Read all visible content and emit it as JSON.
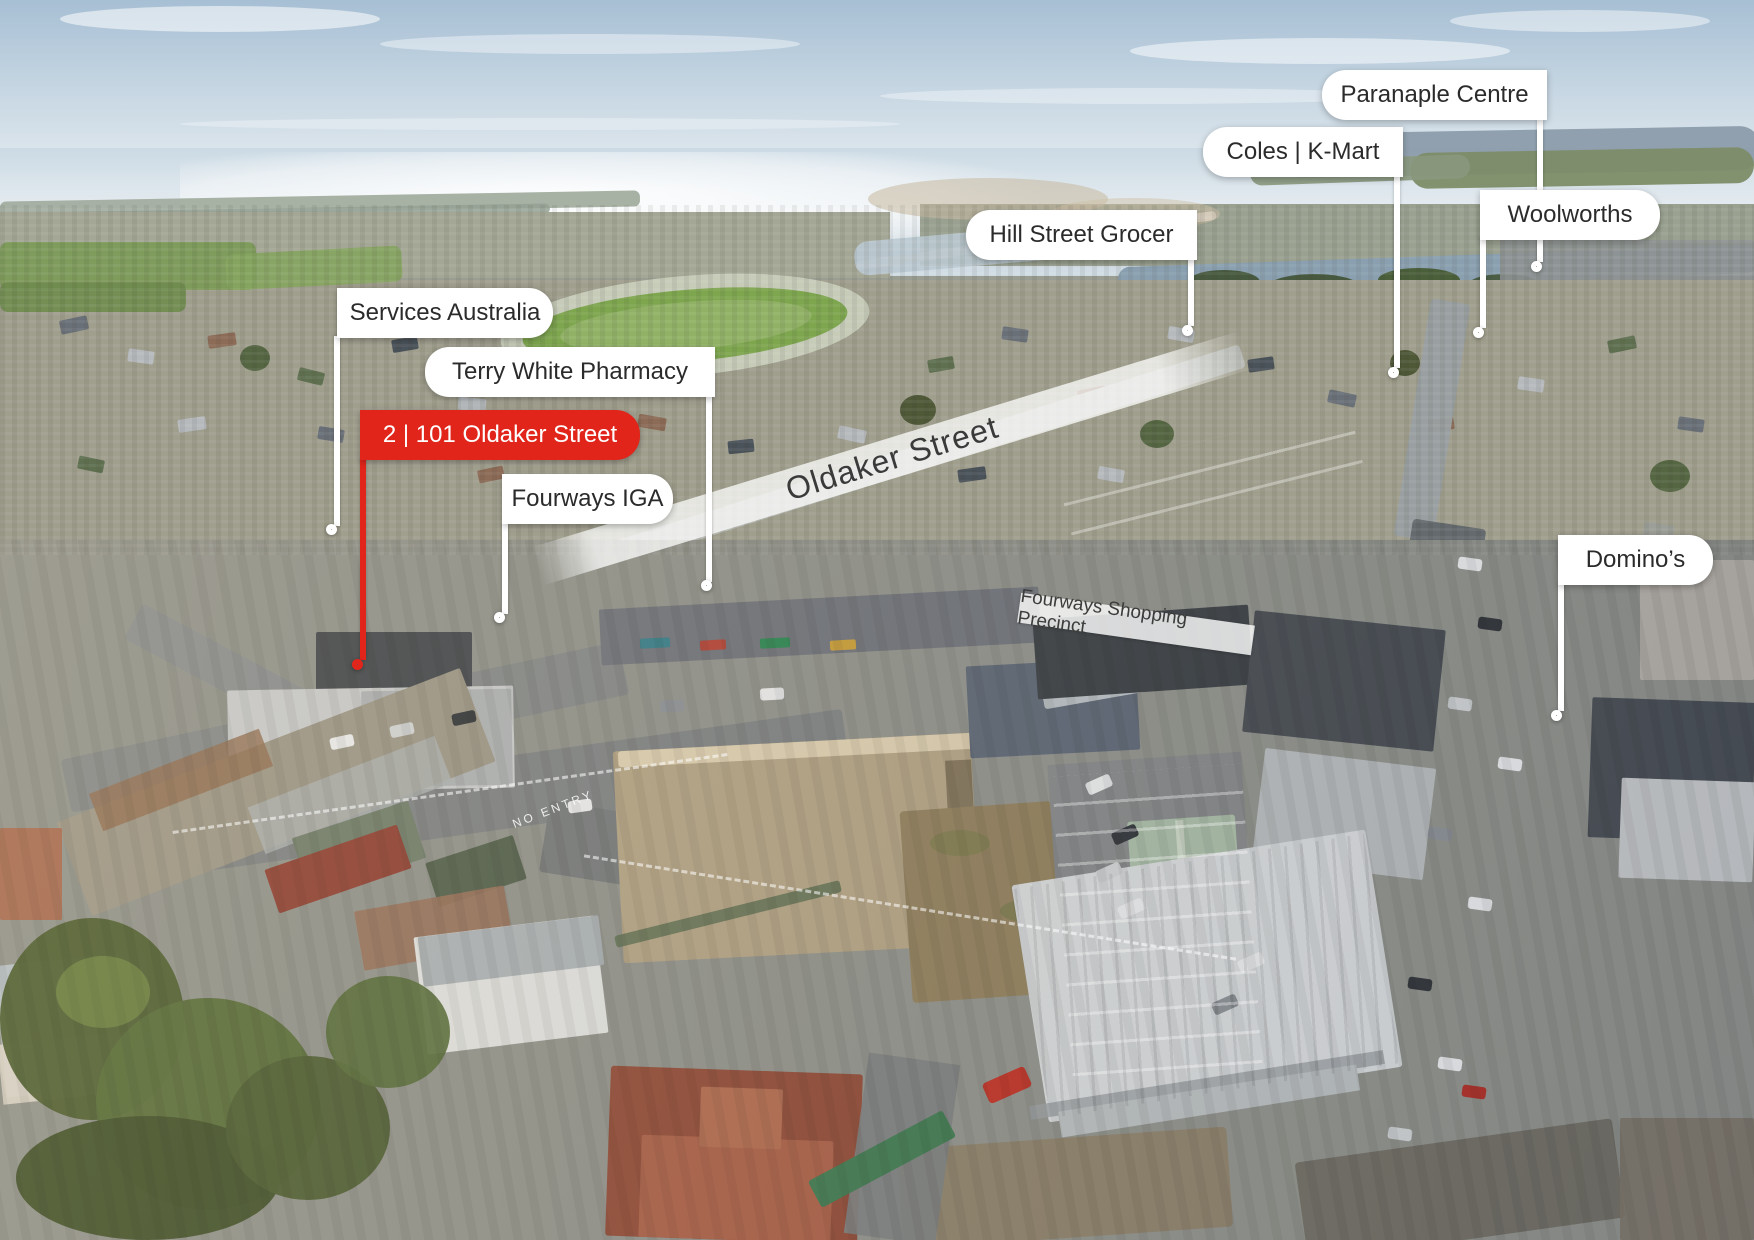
{
  "annotations": {
    "subject": {
      "label": "2 | 101 Oldaker Street"
    },
    "markers": [
      {
        "id": "services-australia",
        "label": "Services Australia"
      },
      {
        "id": "terry-white-pharmacy",
        "label": "Terry White Pharmacy"
      },
      {
        "id": "fourways-iga",
        "label": "Fourways IGA"
      },
      {
        "id": "hill-street-grocer",
        "label": "Hill Street Grocer"
      },
      {
        "id": "coles-kmart",
        "label": "Coles | K-Mart"
      },
      {
        "id": "paranaple-centre",
        "label": "Paranaple Centre"
      },
      {
        "id": "woolworths",
        "label": "Woolworths"
      },
      {
        "id": "dominos",
        "label": "Domino’s"
      }
    ],
    "street_overlay": "Oldaker Street",
    "precinct_overlay": "Fourways Shopping Precinct",
    "road_marking": "NO ENTRY"
  },
  "colors": {
    "accent_red": "#e1251b",
    "label_background": "#ffffff",
    "label_text": "#2b2b2b",
    "overlay_text": "#3a3a3a"
  }
}
